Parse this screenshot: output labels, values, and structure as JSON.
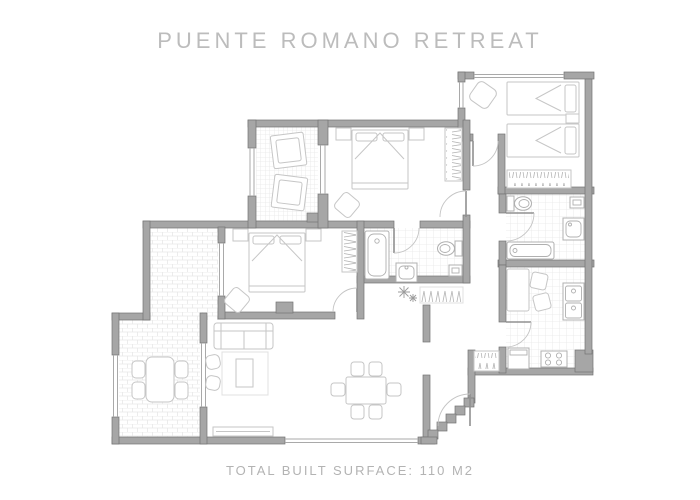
{
  "header": {
    "title": "PUENTE ROMANO RETREAT"
  },
  "footer": {
    "surface_label": "TOTAL BUILT SURFACE: 110 M2"
  },
  "colors": {
    "wall_fill": "#a6a6a6",
    "wall_stroke": "#747474",
    "furniture_line": "#c6c6c6",
    "fixture_line": "#b0b0b0",
    "window_line": "#a9a9a9",
    "door_arc": "#c4c4c4",
    "door_leaf": "#909090",
    "tile_line": "#e7e7e7",
    "hanger_line": "#b4b4b4",
    "title_text": "#bcbcbc",
    "footer_text": "#b3b3b3",
    "background": "#ffffff"
  },
  "floorplan": {
    "icons": [
      "double-bed-icon",
      "single-bed-icon",
      "nightstand-icon",
      "sun-lounger-icon",
      "wardrobe-hangers-icon",
      "coat-rack-icon",
      "sofa-icon",
      "armchair-icon",
      "coffee-table-icon",
      "rug-icon",
      "tv-console-icon",
      "dining-table-icon",
      "chair-icon",
      "outdoor-dining-table-icon",
      "bathtub-icon",
      "toilet-icon",
      "washbasin-icon",
      "mirror-cabinet-icon",
      "kitchen-counter-sink-icon",
      "stove-icon",
      "kitchen-cabinet-icon",
      "kitchen-table-icon",
      "plant-icon",
      "door-swing-icon",
      "window-icon",
      "entry-steps-icon"
    ]
  }
}
